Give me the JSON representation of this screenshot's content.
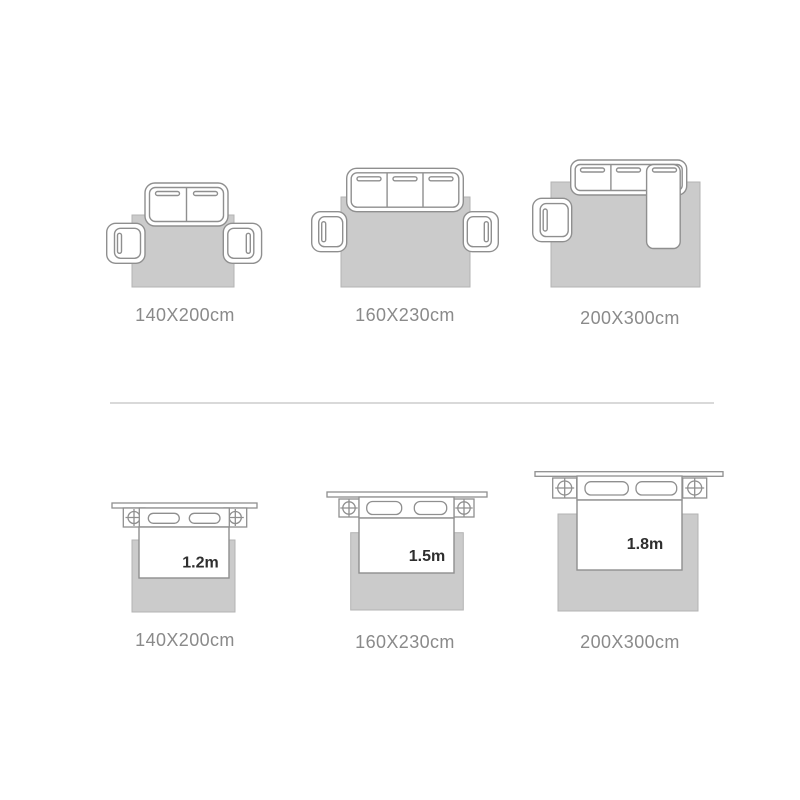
{
  "colors": {
    "background": "#ffffff",
    "rug_fill": "#cbcbcb",
    "rug_border": "#b3b3b3",
    "furniture_line": "#8f8f8f",
    "size_label_text": "#8a8a8a",
    "bed_width_text": "#2e2e2e",
    "divider": "#d9d9d9"
  },
  "sofa_row": {
    "items": [
      {
        "label": "140X200cm"
      },
      {
        "label": "160X230cm"
      },
      {
        "label": "200X300cm"
      }
    ]
  },
  "bed_row": {
    "items": [
      {
        "label": "140X200cm",
        "bed_width": "1.2m"
      },
      {
        "label": "160X230cm",
        "bed_width": "1.5m"
      },
      {
        "label": "200X300cm",
        "bed_width": "1.8m"
      }
    ]
  }
}
